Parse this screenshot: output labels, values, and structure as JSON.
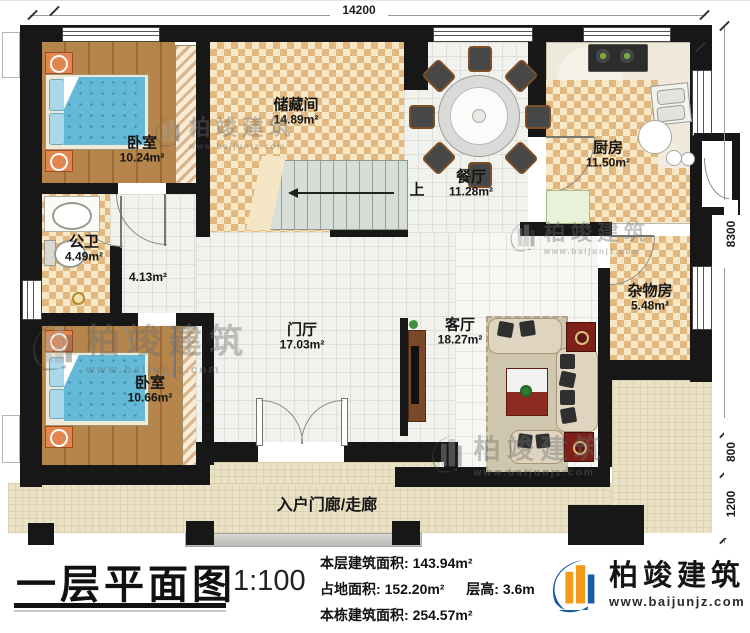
{
  "brand": {
    "name": "柏竣建筑",
    "website": "www.baijunjz.com"
  },
  "title_block": {
    "title": "一层平面图",
    "scale": "1:100",
    "stats": [
      {
        "label": "本层建筑面积: ",
        "value": "143.94m²"
      },
      {
        "label": "占地面积: ",
        "value": "152.20m²"
      },
      {
        "label": "层高: ",
        "value": "3.6m"
      },
      {
        "label": "本栋建筑面积: ",
        "value": "254.57m²"
      }
    ]
  },
  "dimensions": {
    "top": "14200",
    "right_upper": "8300",
    "right_mid": "800",
    "right_lower": "1200"
  },
  "rooms": {
    "bedroom1": {
      "name": "卧室",
      "area": "10.24m²"
    },
    "storage": {
      "name": "储藏间",
      "area": "14.89m²"
    },
    "dining": {
      "name": "餐厅",
      "area": "11.28m²"
    },
    "kitchen": {
      "name": "厨房",
      "area": "11.50m²"
    },
    "bathroom": {
      "name": "公卫",
      "area": "4.49m²"
    },
    "corridor": {
      "area": "4.13m²"
    },
    "bedroom2": {
      "name": "卧室",
      "area": "10.66m²"
    },
    "foyer": {
      "name": "门厅",
      "area": "17.03m²"
    },
    "living": {
      "name": "客厅",
      "area": "18.27m²"
    },
    "utility": {
      "name": "杂物房",
      "area": "5.48m²"
    },
    "porch": {
      "name": "入户门廊/走廊"
    },
    "stairs": {
      "up": "上"
    }
  },
  "colors": {
    "wall": "#171717",
    "checker_dark": "#e2b87e",
    "checker_light": "#f7e9c7",
    "wood_floor": "#ad7b44",
    "bed_blue": "#64b9d6",
    "brand_blue": "#1c5ba6",
    "brand_orange": "#f29b1d",
    "accent_red": "#7d2017"
  }
}
